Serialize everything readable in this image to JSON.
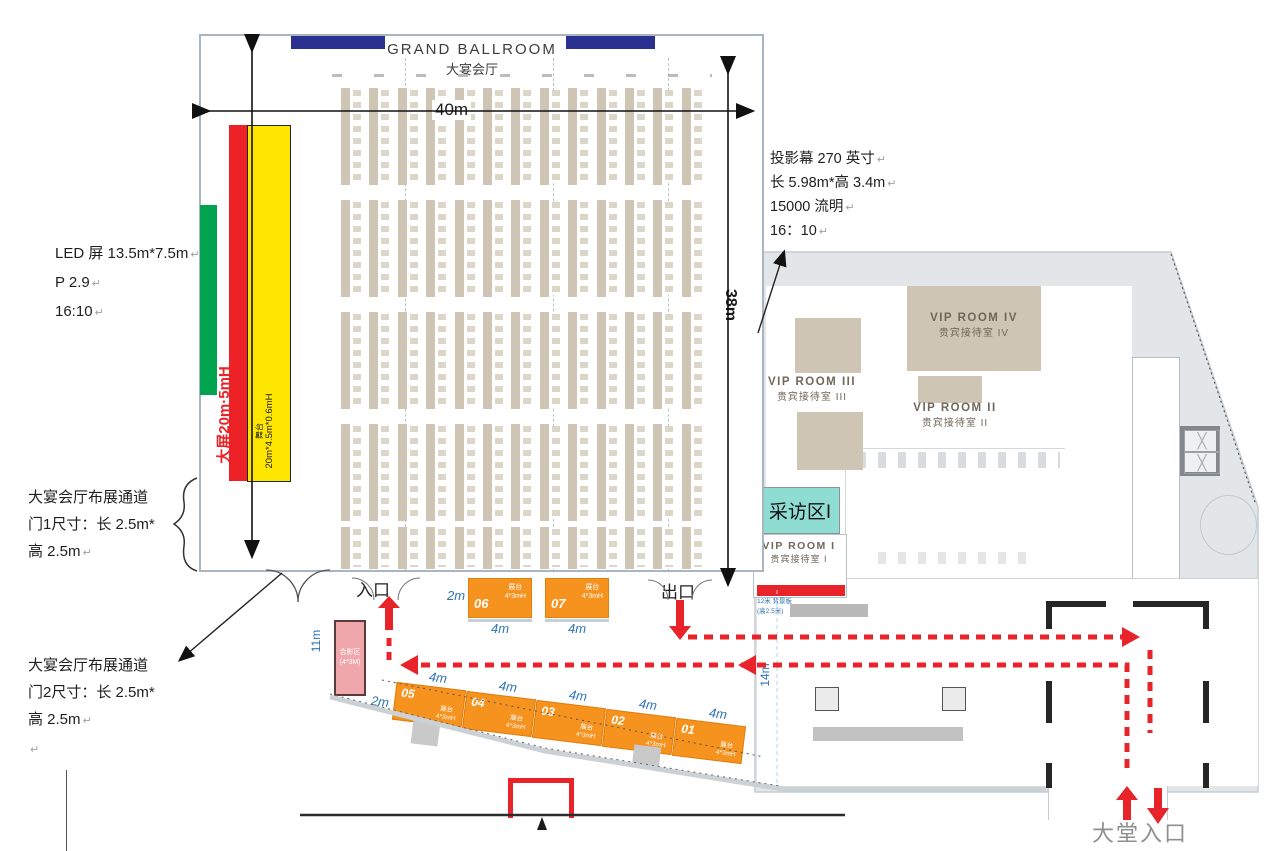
{
  "title": {
    "en": "GRAND BALLROOM",
    "cn": "大宴会厅"
  },
  "measures": {
    "width": "40m",
    "height": "38m",
    "corridor": "14m",
    "photo_wall": "11m"
  },
  "stage": {
    "screen_label": "大屏20m·5mH",
    "stage_name": "舞台",
    "stage_size": "20m*4.5m*0.6mH"
  },
  "notes": {
    "led": [
      "LED 屏 13.5m*7.5m",
      "P 2.9",
      "16:10"
    ],
    "projector": [
      "投影幕 270 英寸",
      "长 5.98m*高 3.4m",
      "15000 流明",
      "16：10"
    ],
    "door1": [
      "大宴会厅布展通道",
      "门1尺寸：长 2.5m*",
      "高 2.5m"
    ],
    "door2": [
      "大宴会厅布展通道",
      "门2尺寸：长 2.5m*",
      "高 2.5m"
    ],
    "backdrop": [
      "12米 背景板",
      "(高2.5米)"
    ]
  },
  "rooms": {
    "vip4": {
      "en": "VIP ROOM IV",
      "cn": "贵宾接待室 IV"
    },
    "vip3": {
      "en": "VIP ROOM III",
      "cn": "贵宾接待室 III"
    },
    "vip2": {
      "en": "VIP ROOM II",
      "cn": "贵宾接待室 II"
    },
    "vip1": {
      "en": "VIP ROOM I",
      "cn": "贵宾接待室 I"
    },
    "interview": "采访区I",
    "photo": {
      "line1": "合影区",
      "line2": "(4*3M)"
    }
  },
  "flow": {
    "entrance": "入口",
    "exit": "出口",
    "lobby_entrance": "大堂入口"
  },
  "booths": {
    "label": "展台",
    "size": "4*3mH",
    "width_label": "4m",
    "depth_label": "2m",
    "top_row": [
      {
        "no": "06"
      },
      {
        "no": "07"
      }
    ],
    "diagonal_row": [
      {
        "no": "05"
      },
      {
        "no": "04"
      },
      {
        "no": "03"
      },
      {
        "no": "02"
      },
      {
        "no": "01"
      }
    ]
  },
  "marks": {
    "return": "↵"
  },
  "colors": {
    "screen_red": "#ec2227",
    "stage_yellow": "#ffe600",
    "led_green": "#00a44f",
    "booth_orange": "#f6921e",
    "interview_teal": "#8fdcd3",
    "path_red": "#e8242a",
    "navy": "#2b3191",
    "dim_blue": "#2e74b5",
    "projection_blue": "#3a55a4",
    "photo_pink": "#f0a7ac"
  }
}
